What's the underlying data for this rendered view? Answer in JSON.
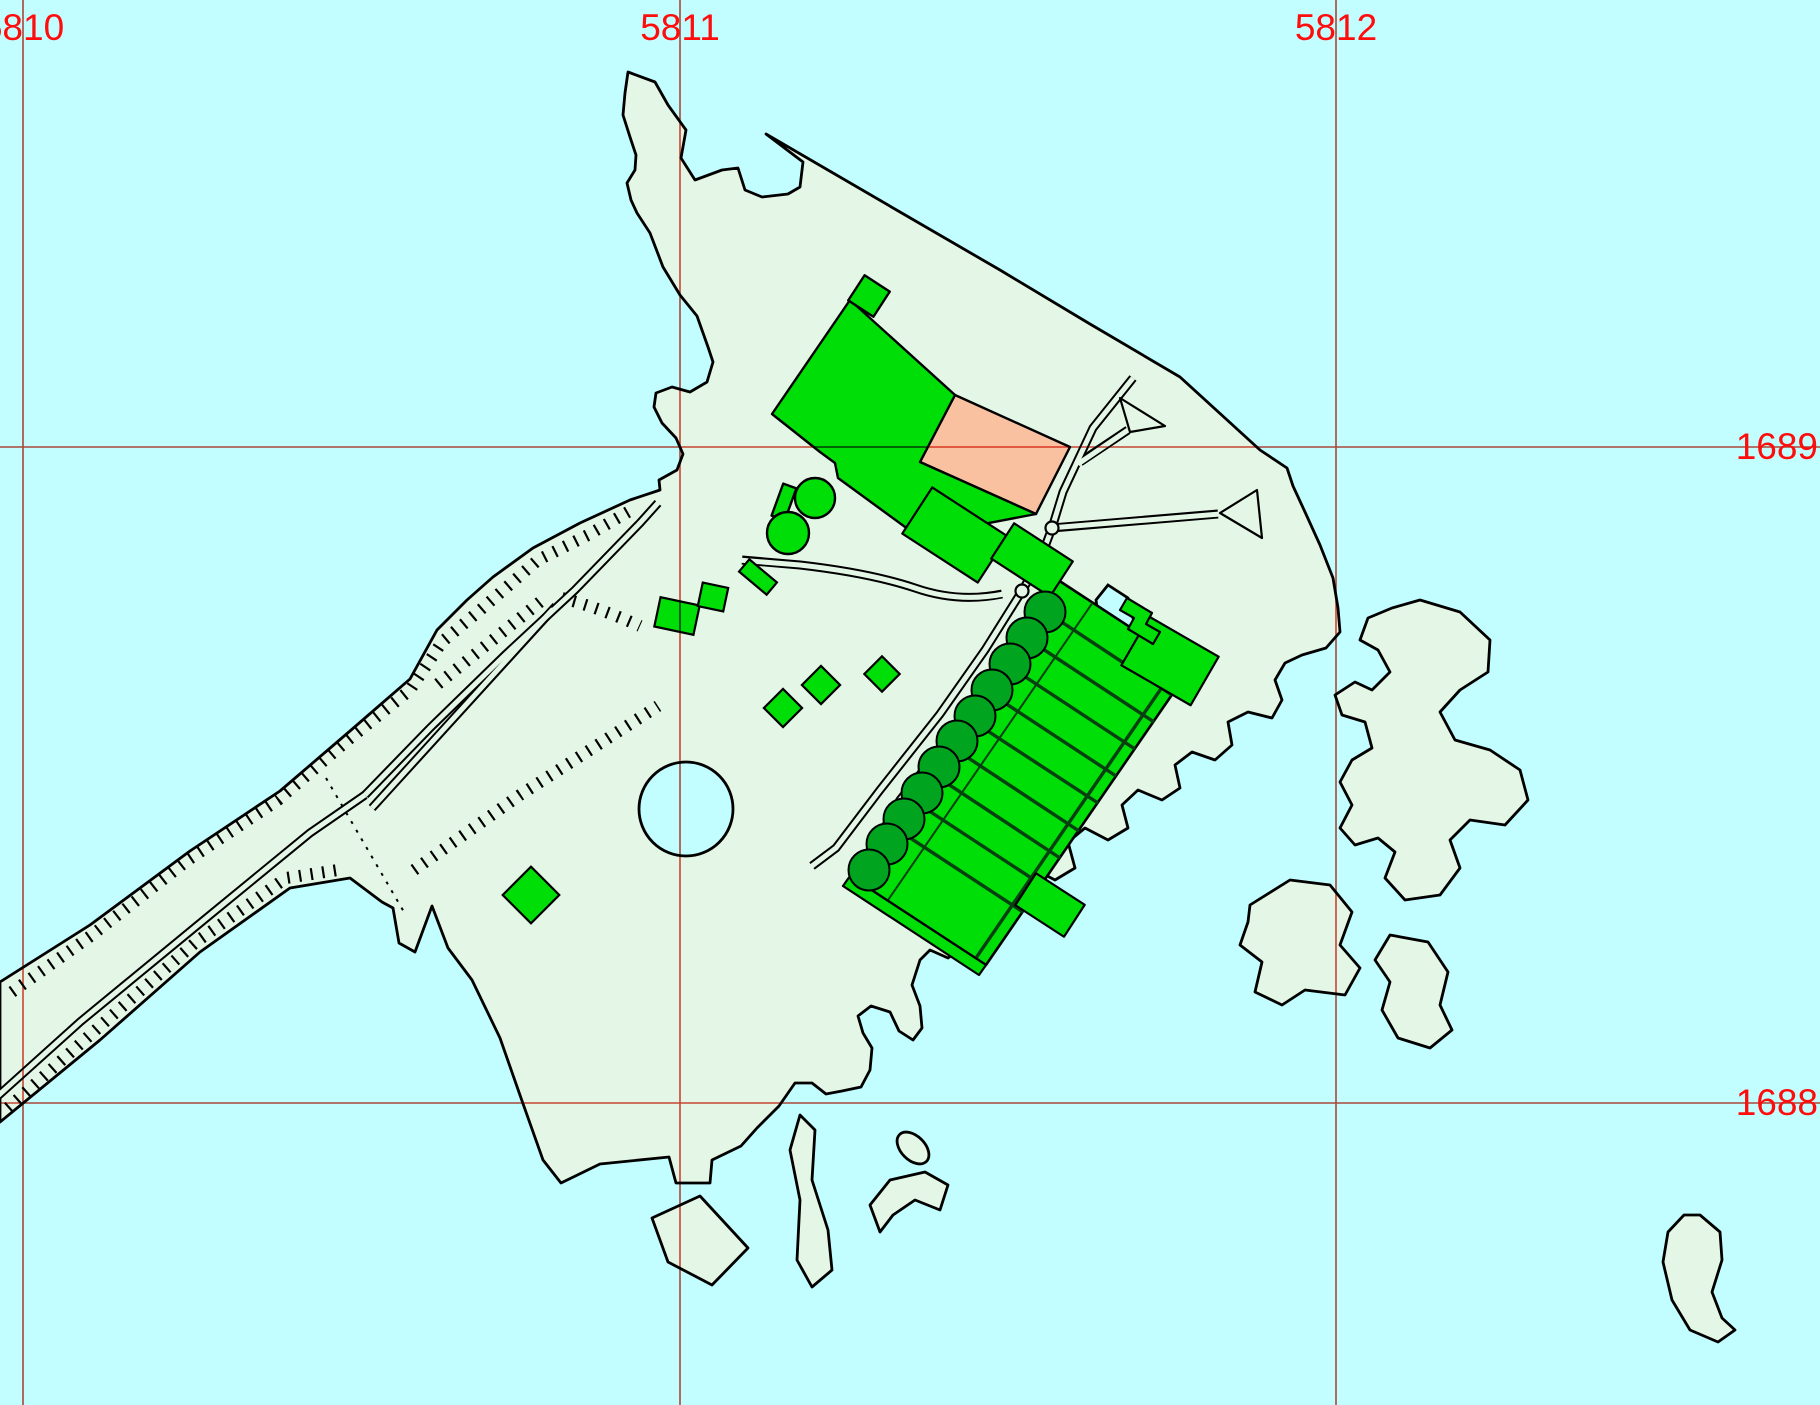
{
  "map": {
    "description": "Topographic cadastral map: island with industrial buildings, tank row, railway causeway, archipelago",
    "colors": {
      "water": "#C2FDFF",
      "land": "#E4F7E6",
      "building": "#00DE07",
      "building_highlight": "#FAC1A0",
      "tank_dark": "#00A41E",
      "gridline": "#E04838",
      "grid_label": "#FF0C0C",
      "outline": "#000000"
    },
    "grid": {
      "vertical": [
        {
          "label": "5810",
          "x": 23
        },
        {
          "label": "5811",
          "x": 680
        },
        {
          "label": "5812",
          "x": 1336
        }
      ],
      "horizontal": [
        {
          "label": "1689",
          "y": 447
        },
        {
          "label": "1688",
          "y": 1103
        }
      ]
    },
    "features": {
      "tank_row_count": 11,
      "storage_tank_pair_count": 2,
      "road_ramp_count": 2
    }
  }
}
